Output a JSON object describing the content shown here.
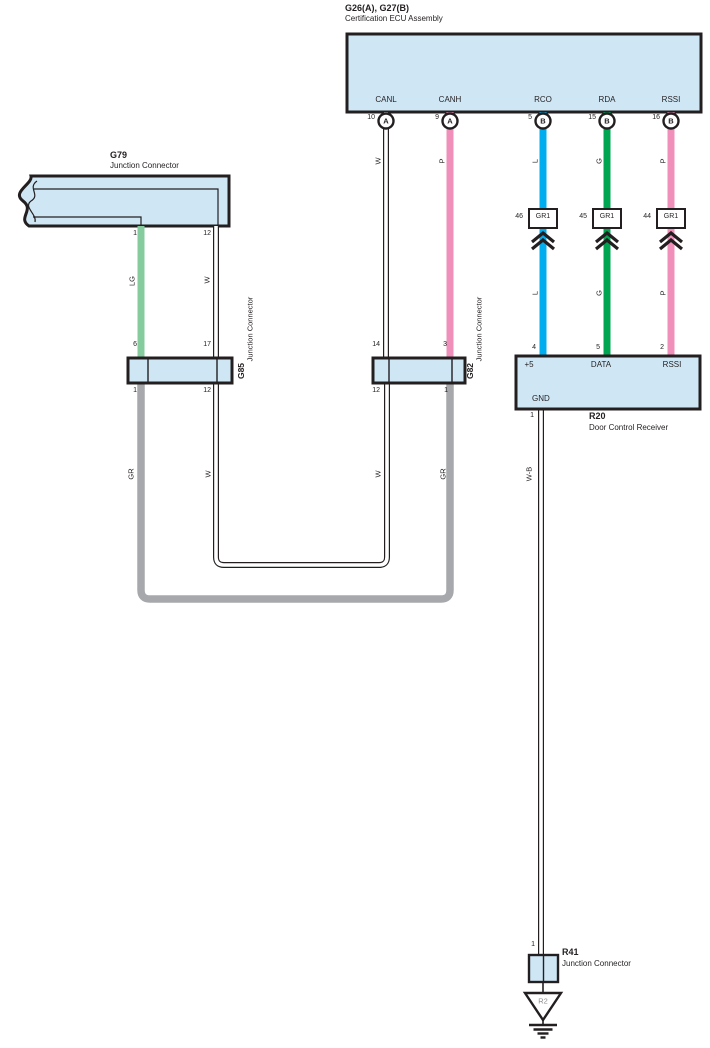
{
  "colors": {
    "panel-fill": "#cfe7f5",
    "line": "#231f20",
    "wire-blue": "#00aeef",
    "wire-green": "#00a551",
    "wire-pink": "#ef8fba",
    "wire-lightgreen": "#85cb9e",
    "wire-gray": "#a6a8ab"
  },
  "ecu": {
    "id": "G26(A), G27(B)",
    "name": "Certification ECU Assembly",
    "pins": [
      {
        "label": "CANL",
        "num": "10",
        "connector": "A",
        "wire": "W"
      },
      {
        "label": "CANH",
        "num": "9",
        "connector": "A",
        "wire": "P"
      },
      {
        "label": "RCO",
        "num": "5",
        "connector": "B",
        "wire": "L"
      },
      {
        "label": "RDA",
        "num": "15",
        "connector": "B",
        "wire": "G"
      },
      {
        "label": "RSSI",
        "num": "16",
        "connector": "B",
        "wire": "P"
      }
    ]
  },
  "gr1": {
    "label": "GR1",
    "pins": [
      "46",
      "45",
      "44"
    ]
  },
  "lower_wires": [
    "L",
    "G",
    "P"
  ],
  "g79": {
    "id": "G79",
    "name": "Junction Connector",
    "pins": {
      "left": "1",
      "right": "12"
    },
    "wires": {
      "left": "LG",
      "right": "W"
    }
  },
  "g85": {
    "id": "G85",
    "name": "Junction Connector",
    "pins": {
      "top_left": "6",
      "top_right": "17",
      "bottom_left": "1",
      "bottom_right": "12"
    }
  },
  "g82": {
    "id": "G82",
    "name": "Junction Connector",
    "pins": {
      "top_left": "14",
      "top_right": "3",
      "bottom_left": "12",
      "bottom_right": "1"
    }
  },
  "loop": {
    "gr_left": "GR",
    "w_left": "W",
    "w_right": "W",
    "gr_right": "GR"
  },
  "r20": {
    "id": "R20",
    "name": "Door Control Receiver",
    "pins_top": [
      {
        "num": "4",
        "label": "+5"
      },
      {
        "num": "5",
        "label": "DATA"
      },
      {
        "num": "2",
        "label": "RSSI"
      }
    ],
    "gnd": {
      "label": "GND",
      "num": "1",
      "wire": "W-B"
    }
  },
  "r41": {
    "id": "R41",
    "name": "Junction Connector",
    "pin": "1"
  },
  "ground": {
    "label": "R2"
  }
}
